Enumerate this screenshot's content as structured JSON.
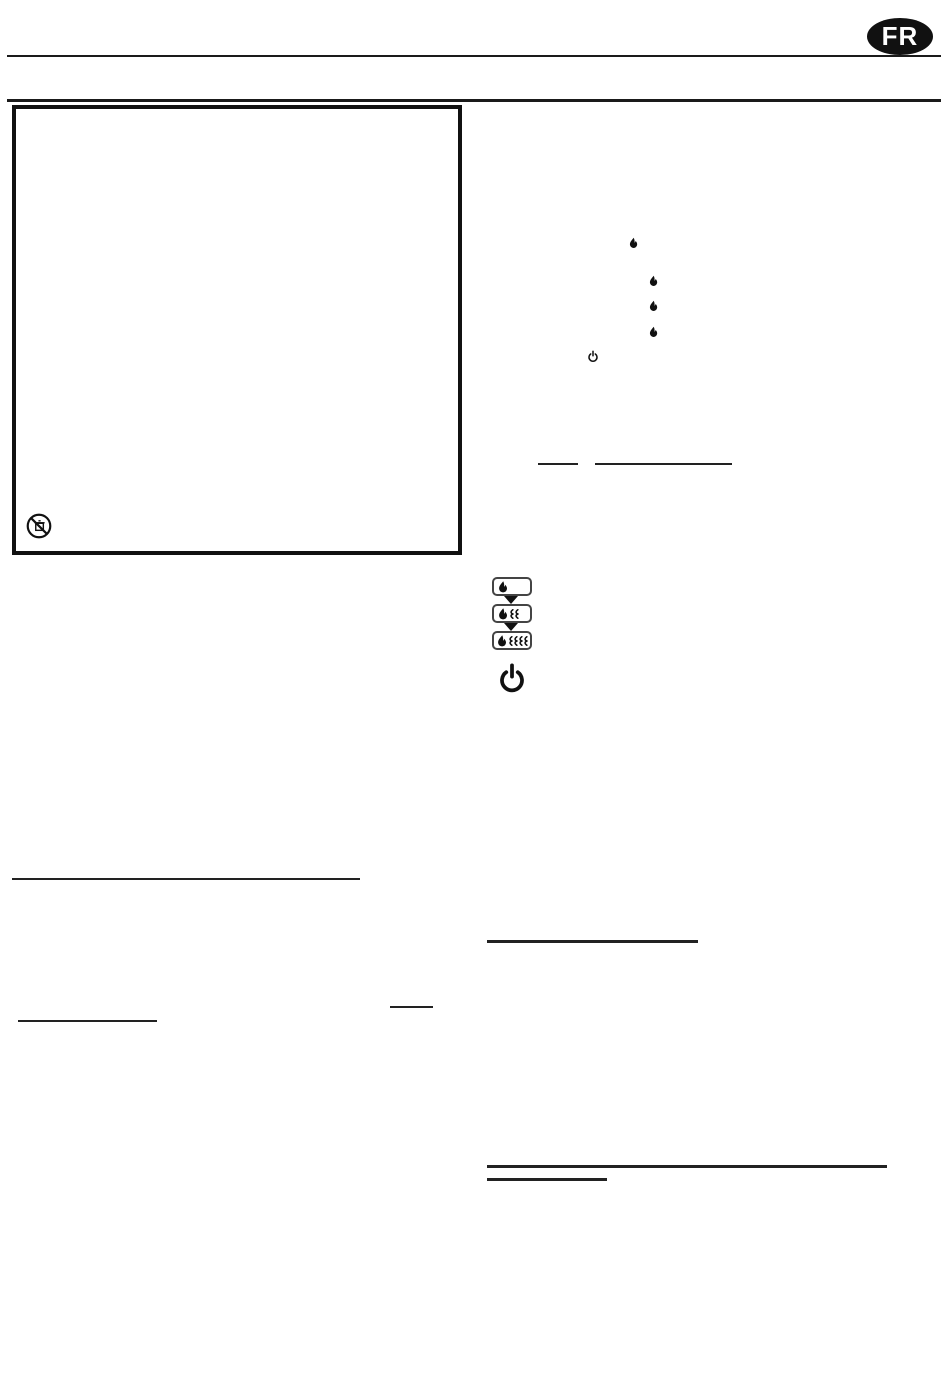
{
  "page": {
    "kind": "user-manual-page",
    "background": "#ffffff",
    "ink": "#1a1a1a"
  },
  "header": {
    "language_badge": {
      "label": "FR",
      "background": "#111111",
      "text_color": "#ffffff"
    }
  },
  "safety_box": {
    "icons": [
      {
        "name": "no-trash-disposal-icon"
      }
    ]
  },
  "body_icons": {
    "flame_markers": [
      {
        "name": "flame-icon"
      },
      {
        "name": "flame-icon"
      },
      {
        "name": "flame-icon"
      },
      {
        "name": "flame-icon"
      }
    ],
    "power_marker": {
      "name": "power-icon"
    }
  },
  "heat_mode_diagram": {
    "buttons": [
      {
        "name": "heat-level-1-button",
        "flame_icons": 1,
        "heat_waves": 0
      },
      {
        "name": "heat-level-2-button",
        "flame_icons": 1,
        "heat_waves": 2
      },
      {
        "name": "heat-level-3-button",
        "flame_icons": 1,
        "heat_waves": 4
      }
    ],
    "separator": "arrow-down-icon",
    "power_icon": "power-icon"
  }
}
